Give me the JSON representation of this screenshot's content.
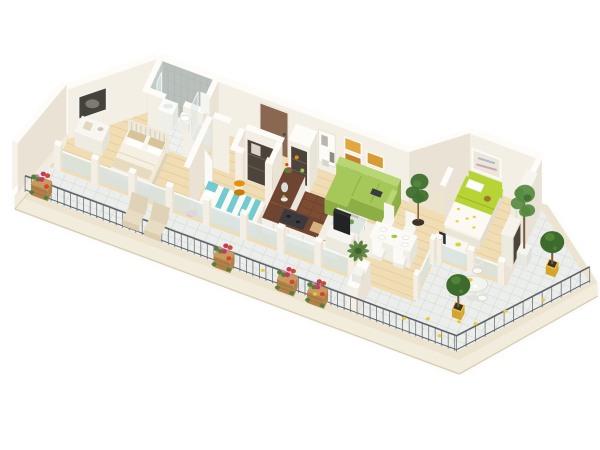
{
  "meta": {
    "description": "3D isometric cutaway floor plan rendering of an apartment with balcony and terrace",
    "view": "isometric-render",
    "background": "#ffffff"
  },
  "rooms": [
    {
      "name": "master-bedroom"
    },
    {
      "name": "bathroom"
    },
    {
      "name": "hallway"
    },
    {
      "name": "second-bedroom"
    },
    {
      "name": "closet-room"
    },
    {
      "name": "kitchen"
    },
    {
      "name": "living-room"
    },
    {
      "name": "dining-area"
    },
    {
      "name": "kids-bedroom"
    },
    {
      "name": "balcony"
    },
    {
      "name": "terrace"
    }
  ],
  "objects": [
    "double-bed",
    "sideboard",
    "bw-wall-picture",
    "bathroom-sink",
    "mirror",
    "toilet",
    "shower",
    "towel",
    "entry-door",
    "daybed",
    "side-stool",
    "closet-niche",
    "pantry-cabinet",
    "kitchen-counter",
    "cooktop",
    "sofa",
    "coffee-table",
    "tv-stand",
    "wall-art-amber",
    "recessed-shelf",
    "dining-table",
    "dining-chairs",
    "kids-bed",
    "kids-desk",
    "kids-wardrobe",
    "kids-wall-picture",
    "indoor-ficus",
    "indoor-palm",
    "lounge-chairs",
    "flower-baskets",
    "railing",
    "terrace-table",
    "terrace-chairs",
    "topiary-trees",
    "tall-potted-tree",
    "lemons"
  ],
  "palette": {
    "bg": "#ffffff",
    "shadow": "#3c3c32",
    "slabTop": "#ece4cf",
    "slabFace": "#f2ecdc",
    "slabEdge": "#d8cdb2",
    "wood": "#f1ddb4",
    "woodLine": "#dfc391",
    "bathFloor": "#eff1ee",
    "bathFloorLine": "#dbdedb",
    "kitchenFloor": "#7c4c34",
    "kitchenFloorLine": "#6a3f2b",
    "terr": "#eceeeb",
    "terrLine": "#d7dad5",
    "wallS": "#f4efe4",
    "wallE": "#e9e2d5",
    "wallTop": "#fdfcf8",
    "wallOuter": "#f6f2e8",
    "bathA": "#b9bfbb",
    "bathB": "#c8ceca",
    "bathLine": "#a9afab",
    "glass": "#d8e4e2",
    "rail": "#5c6267",
    "door": "#8a6750",
    "doorFrame": "#efe9dc",
    "sofa": "#a6c85b",
    "sofaDk": "#8cae45",
    "sofaLt": "#b9d675",
    "kidGreen": "#b6d434",
    "kidGreenDk": "#9cbb2a",
    "teal": "#72cbd1",
    "orange": "#e59110",
    "orangeDk": "#c97c0b",
    "counterTop": "#6f4430",
    "cabinet": "#f2f0e8",
    "cabinetDk": "#e9e6dc",
    "appliance": "#3b3b3e",
    "niche": "#4c433b",
    "artDark": "#45423b",
    "artMat": "#f2f1ec",
    "artSwirl": "#8b8880",
    "amberA": "#c9802b",
    "amberB": "#e3a73d",
    "amberC": "#8f5c21",
    "amberD": "#d99b34",
    "amberE": "#b06b1f",
    "pink": "#e07da9",
    "crimson": "#c23c55",
    "red": "#ce4a30",
    "leaf": "#55803c",
    "leafDk": "#3f6129",
    "topiary": "#3d6b2e",
    "topiaryLt": "#538a39",
    "tree": "#568a40",
    "treeDk": "#40702f",
    "trunk": "#7a5c3e",
    "pot": "#edc23b",
    "potDk": "#d4a52c",
    "basket": "#c99a5f",
    "basketDk": "#b0824a",
    "beige": "#d9c49a",
    "cream": "#eadfc8",
    "white": "#ffffff",
    "offwhite": "#f8f7f2",
    "rug": "#f3efe5",
    "mirror": "#cfe0df",
    "glassTable": "#d7e3df",
    "pinkThrow": "#eaa8bc",
    "teddy": "#a5762f",
    "yellowToy": "#d6d23b",
    "lemon": "#e9cb3a",
    "pastelArt": "#eee7d9"
  }
}
